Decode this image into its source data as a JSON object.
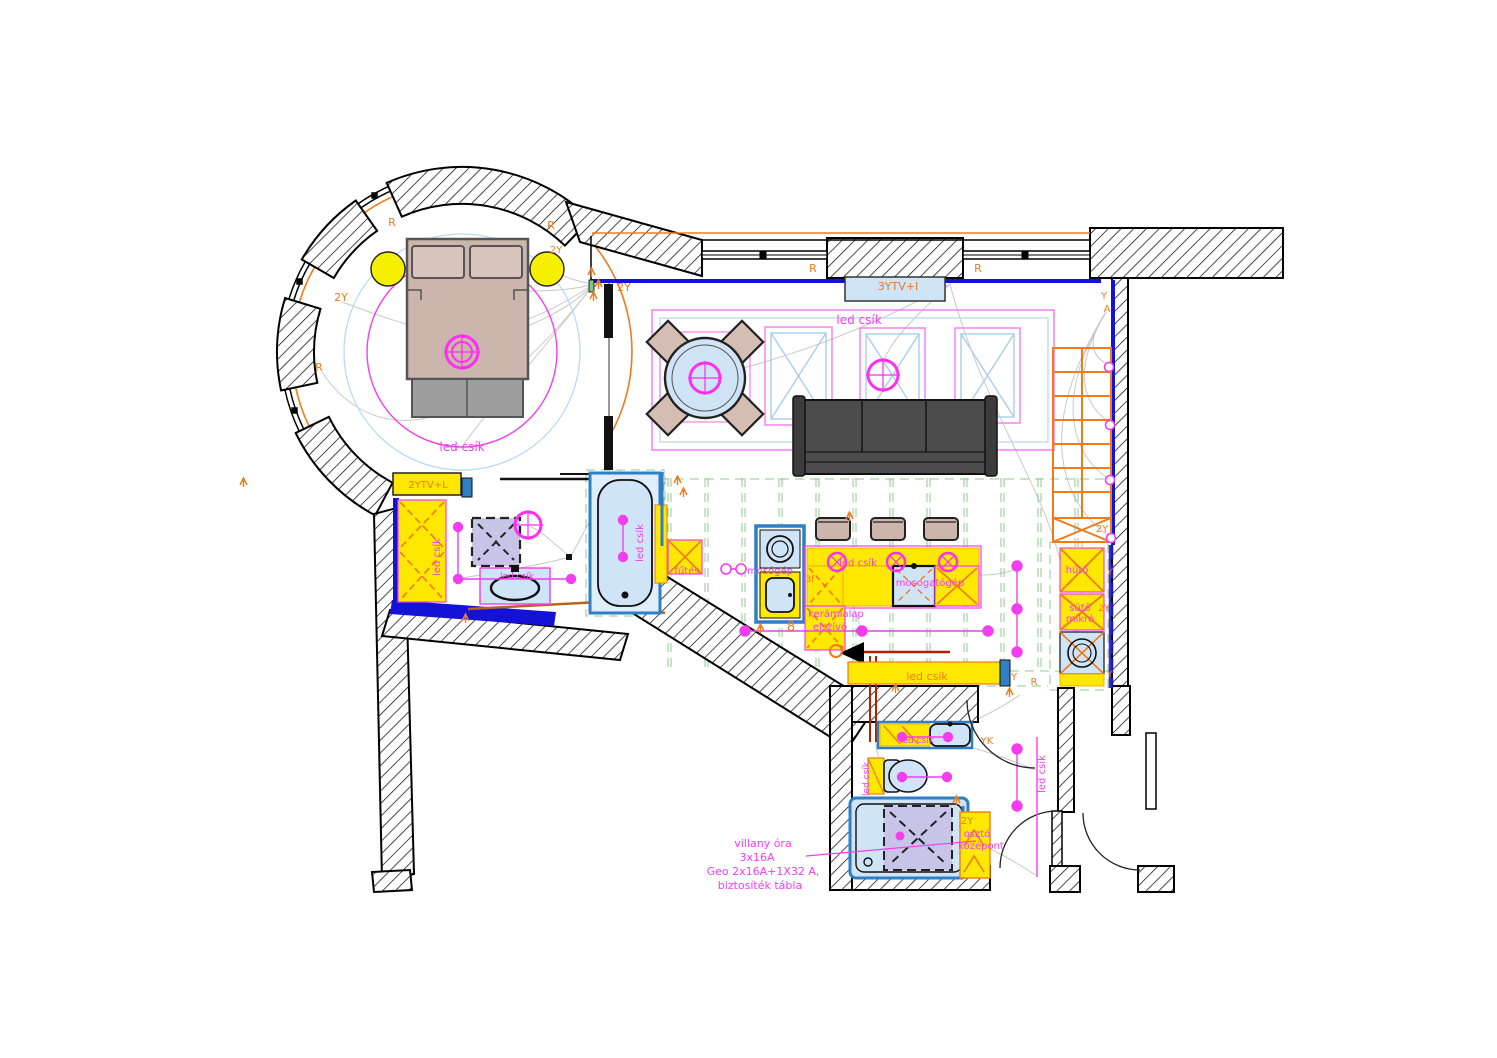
{
  "document": {
    "type": "apartment floor plan – lighting and electrical layout",
    "language": "Hungarian"
  },
  "colors": {
    "wall_outline": "#000000",
    "wall_inner_navy": "#1512d8",
    "accent_orange": "#ef7b1a",
    "accent_magenta": "#f43df0",
    "cabinet_yellow": "#ffe800",
    "water_blue": "#cfe4f6",
    "fixture_frame_blue": "#2e7fc4",
    "ceiling_grid_green": "#8fc98f",
    "wire_gray": "#c8c8c8",
    "sofa_gray": "#4c4c4c",
    "wood_tan": "#cbb5ac",
    "shower_lavender": "#c8c4e8",
    "dark_red": "#b22000"
  },
  "labels": {
    "bedroom": {
      "led": "led csík",
      "r_top_left": "R",
      "r_top_right": "R",
      "y2_left": "2Y",
      "r_left": "R",
      "y2_door": "2Y"
    },
    "living": {
      "y2_door": "2Y",
      "r_window1": "R",
      "r_window2": "R",
      "tv": "3YTV+I",
      "led": "led csík",
      "y_corner": "Y",
      "a_corner": "A",
      "y2_stairs": "2Y"
    },
    "bath1": {
      "tv": "2YTV+L",
      "led_wardrobe": "led csík",
      "led_basin": "led csík",
      "led_tub": "led csík"
    },
    "kitchen": {
      "heater": "fűtés",
      "washer": "mosógép",
      "phase": "3f",
      "led_island": "led csík",
      "dishwasher": "mosogatógép",
      "hob1": "kerámialap",
      "hob2": "elszívó",
      "sym8": "8",
      "led_wall": "led csík",
      "y_wall": "Y",
      "r_wall": "R",
      "fridge": "hűtő",
      "y_col1": "Y",
      "oven1": "sütő",
      "oven2": "mikró",
      "y2_col": "2Y",
      "y_col2": "Y"
    },
    "bath2": {
      "led_basin": "led csík",
      "led_left": "led csík",
      "yk": "YK",
      "y2": "2Y",
      "dist1": "osztó",
      "dist2": "középont"
    },
    "hall": {
      "led": "led csík"
    },
    "panel_note": {
      "line1": "villany óra",
      "line2": "3x16A",
      "line3": "Geo 2x16A+1X32 A,",
      "line4": "biztosíték tábla"
    }
  }
}
